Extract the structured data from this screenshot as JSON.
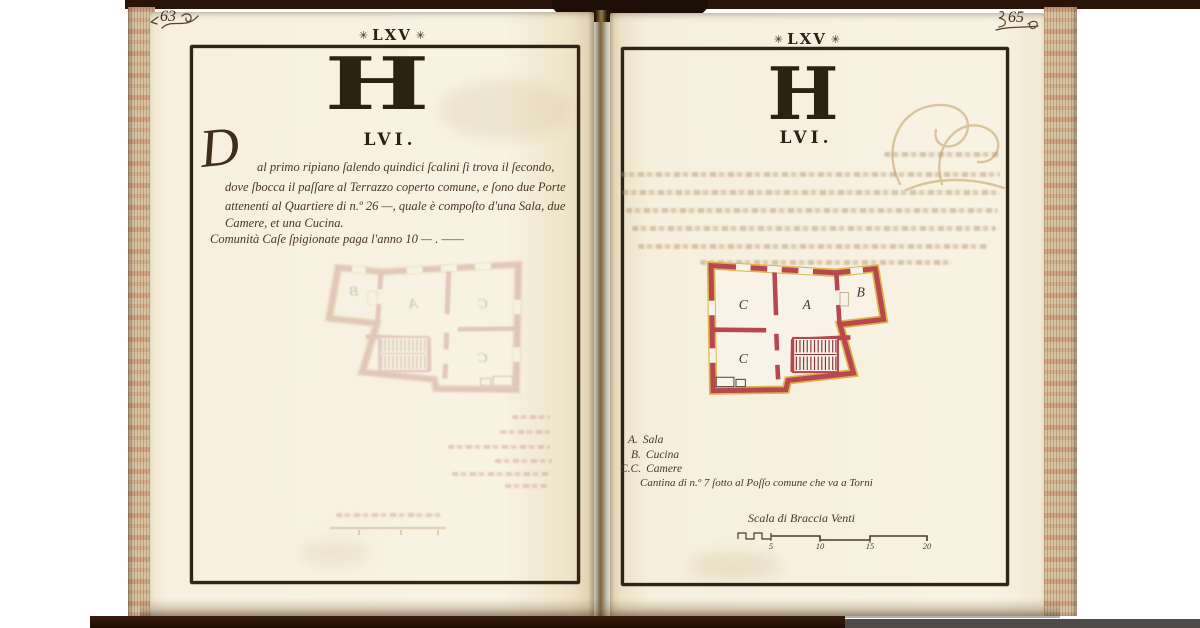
{
  "colors": {
    "page_cream": "#f8f2e3",
    "ink_black": "#2b2214",
    "handwriting_brown": "#4a3522",
    "plan_wall_red": "#b8474f",
    "plan_outline_yellow": "#dcb64e",
    "fore_edge_tan": "#d8c4a3",
    "binding_brown": "#2a1408"
  },
  "left_page": {
    "folio_number": "63",
    "header": {
      "ornament": "✳",
      "text": "LXV"
    },
    "section_letter": "H",
    "section_numeral": "LVI.",
    "paragraph": {
      "initial": "D",
      "lines": [
        "al primo ripiano ſalendo quindici ſcalini ſi trova il ſecondo,",
        "dove ſbocca il paſſare al Terrazzo coperto comune, e ſono due Porte",
        "attenenti al Quartiere di n.º 26 —, quale è compoſto d'una Sala, due",
        "Camere, et una Cucina."
      ]
    },
    "rent_line": "Comunità Caſe ſpigionate paga l'anno 10 — . ——"
  },
  "right_page": {
    "folio_number": "65",
    "header": {
      "ornament": "✳",
      "text": "LXV"
    },
    "section_letter": "H",
    "section_numeral": "LVI.",
    "plan": {
      "rooms": {
        "hall": "A",
        "kitchen": "B",
        "chamber_upper": "C",
        "chamber_lower": "C"
      }
    },
    "legend": {
      "entries": [
        {
          "key": "A.",
          "value": "Sala"
        },
        {
          "key": "B.",
          "value": "Cucina"
        },
        {
          "key": "C.C.",
          "value": "Camere"
        }
      ],
      "note": "Cantina di n.º 7 ſotto al Poſſo comune che va a Torni"
    },
    "scale_bar": {
      "label": "Scala di Braccia Venti",
      "ticks": [
        "5",
        "10",
        "15",
        "20"
      ]
    }
  }
}
